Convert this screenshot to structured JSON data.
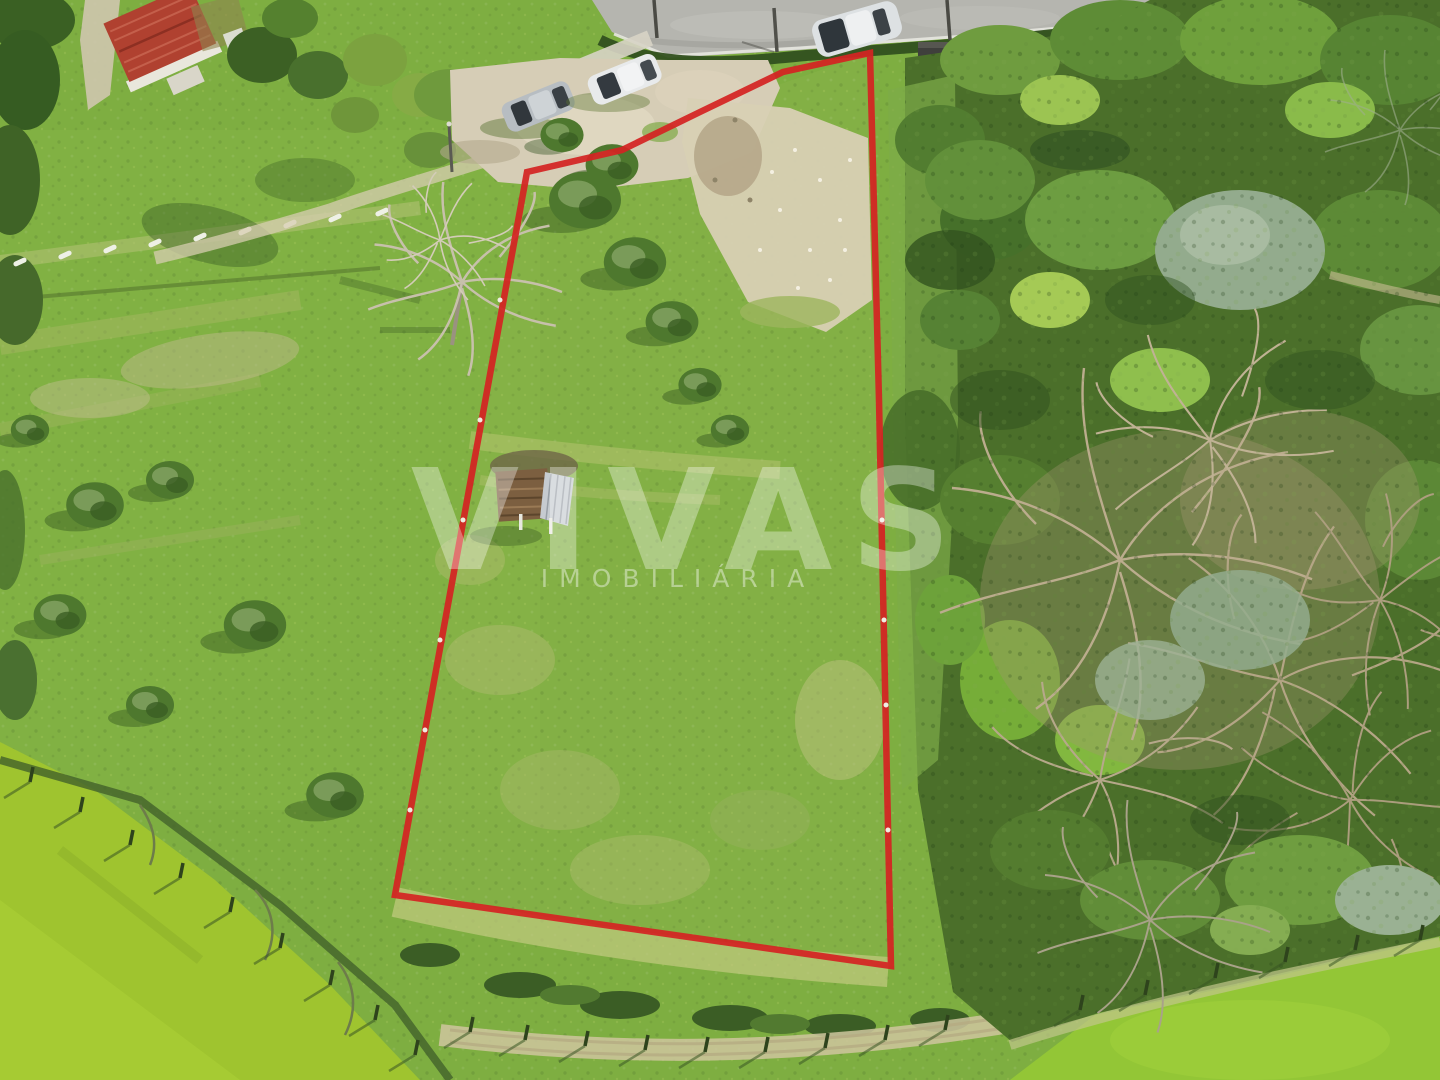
{
  "meta": {
    "description": "Aerial drone photograph of a rural land parcel for sale, outlined in red, with grassy fields, olive trees, parked cars by a road at top, a red-roof house at top-left, dense forest on the right and bright meadows at bottom",
    "width": 1440,
    "height": 1080
  },
  "watermark": {
    "brand": "VIVAS",
    "subtitle": "IMOBILIÁRIA",
    "color": "#ffffff"
  },
  "boundary": {
    "color": "#d42322",
    "stroke_width": "6.5",
    "points": "527,172 622,150 700,112 783,72 870,53 879,400 887,780 891,966 395,895"
  },
  "palette": {
    "grass_base": "#7eae41",
    "meadow_bright": "#9fc42f",
    "forest_dark": "#4b6f2a",
    "sand": "#d8d0b4",
    "road_asphalt": "#b5b5af",
    "house_roof_red": "#b04130",
    "bare_branches": "#bdaf92"
  },
  "scene": {
    "objects": [
      "red-roof-house",
      "road-top",
      "parked-car-silver",
      "parked-car-white",
      "car-on-road",
      "parking-dirt-area",
      "parcel-boundary-red",
      "olive-trees",
      "bare-leafless-trees",
      "wood-shed-log-pile",
      "forest-right",
      "meadow-bottom-left",
      "meadow-bottom-right",
      "fence-posts",
      "dirt-paths"
    ]
  }
}
